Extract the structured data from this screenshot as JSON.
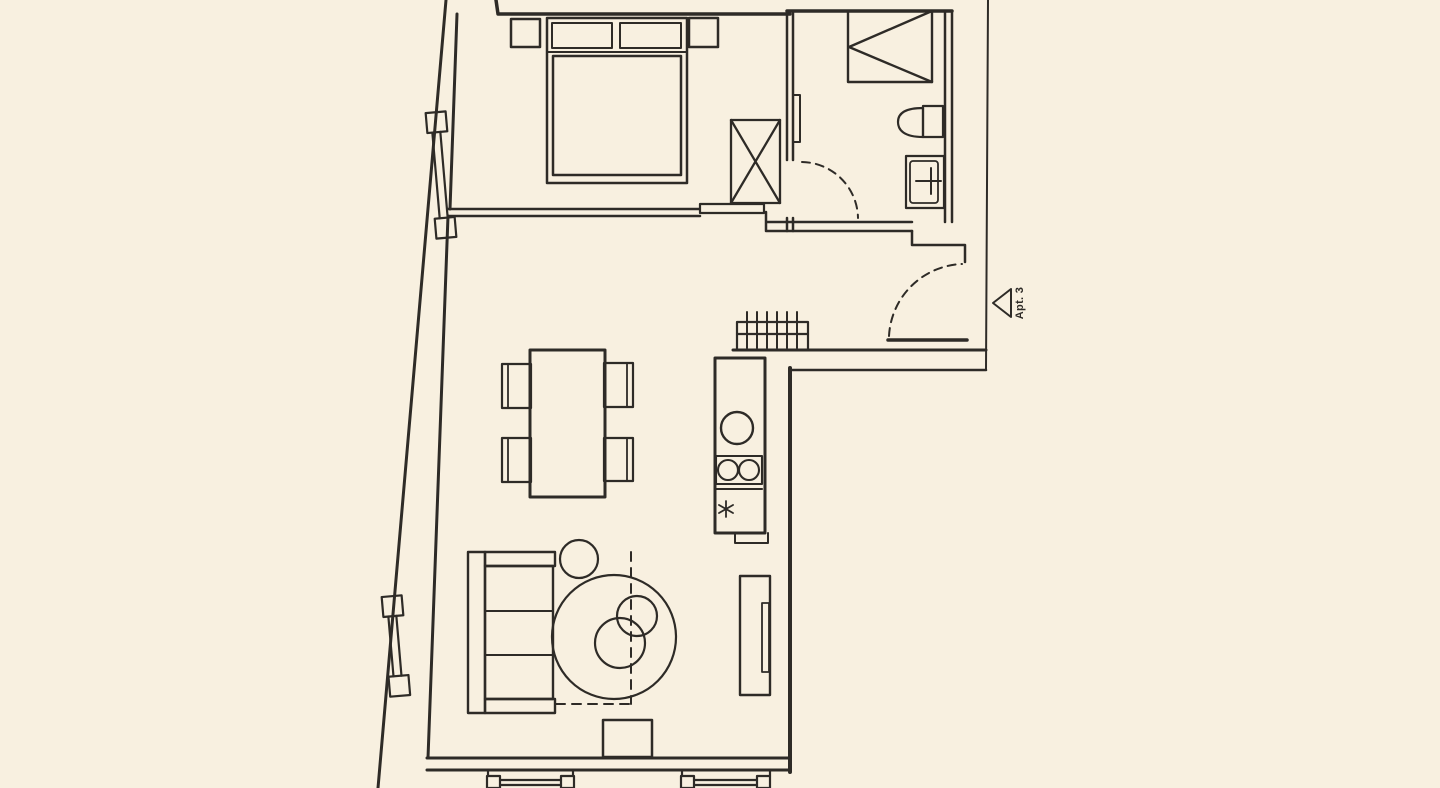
{
  "page": {
    "background_color": "#f8f0e0",
    "line_color": "#2e2b27"
  },
  "entrance": {
    "label": "Apt. 3",
    "marker": "left-pointing-triangle"
  },
  "rooms": [
    "bedroom",
    "bathroom",
    "hallway",
    "kitchen",
    "living-dining-area"
  ],
  "furniture_and_fixtures": [
    "double-bed",
    "pillows",
    "nightstand-left",
    "nightstand-right",
    "wardrobe",
    "shower",
    "toilet",
    "washbasin",
    "bathroom-radiator",
    "bathroom-door",
    "bedroom-sliding-door",
    "entrance-door",
    "drying-rack",
    "kitchen-counter",
    "kitchen-sink",
    "two-burner-hob",
    "freezer",
    "dining-table",
    "dining-chair",
    "sofa",
    "stool",
    "round-rug",
    "nesting-coffee-tables",
    "tv-unit",
    "sideboard",
    "slanted-wall-window-bedroom",
    "slanted-wall-window-living",
    "bottom-window-left",
    "bottom-window-right"
  ]
}
